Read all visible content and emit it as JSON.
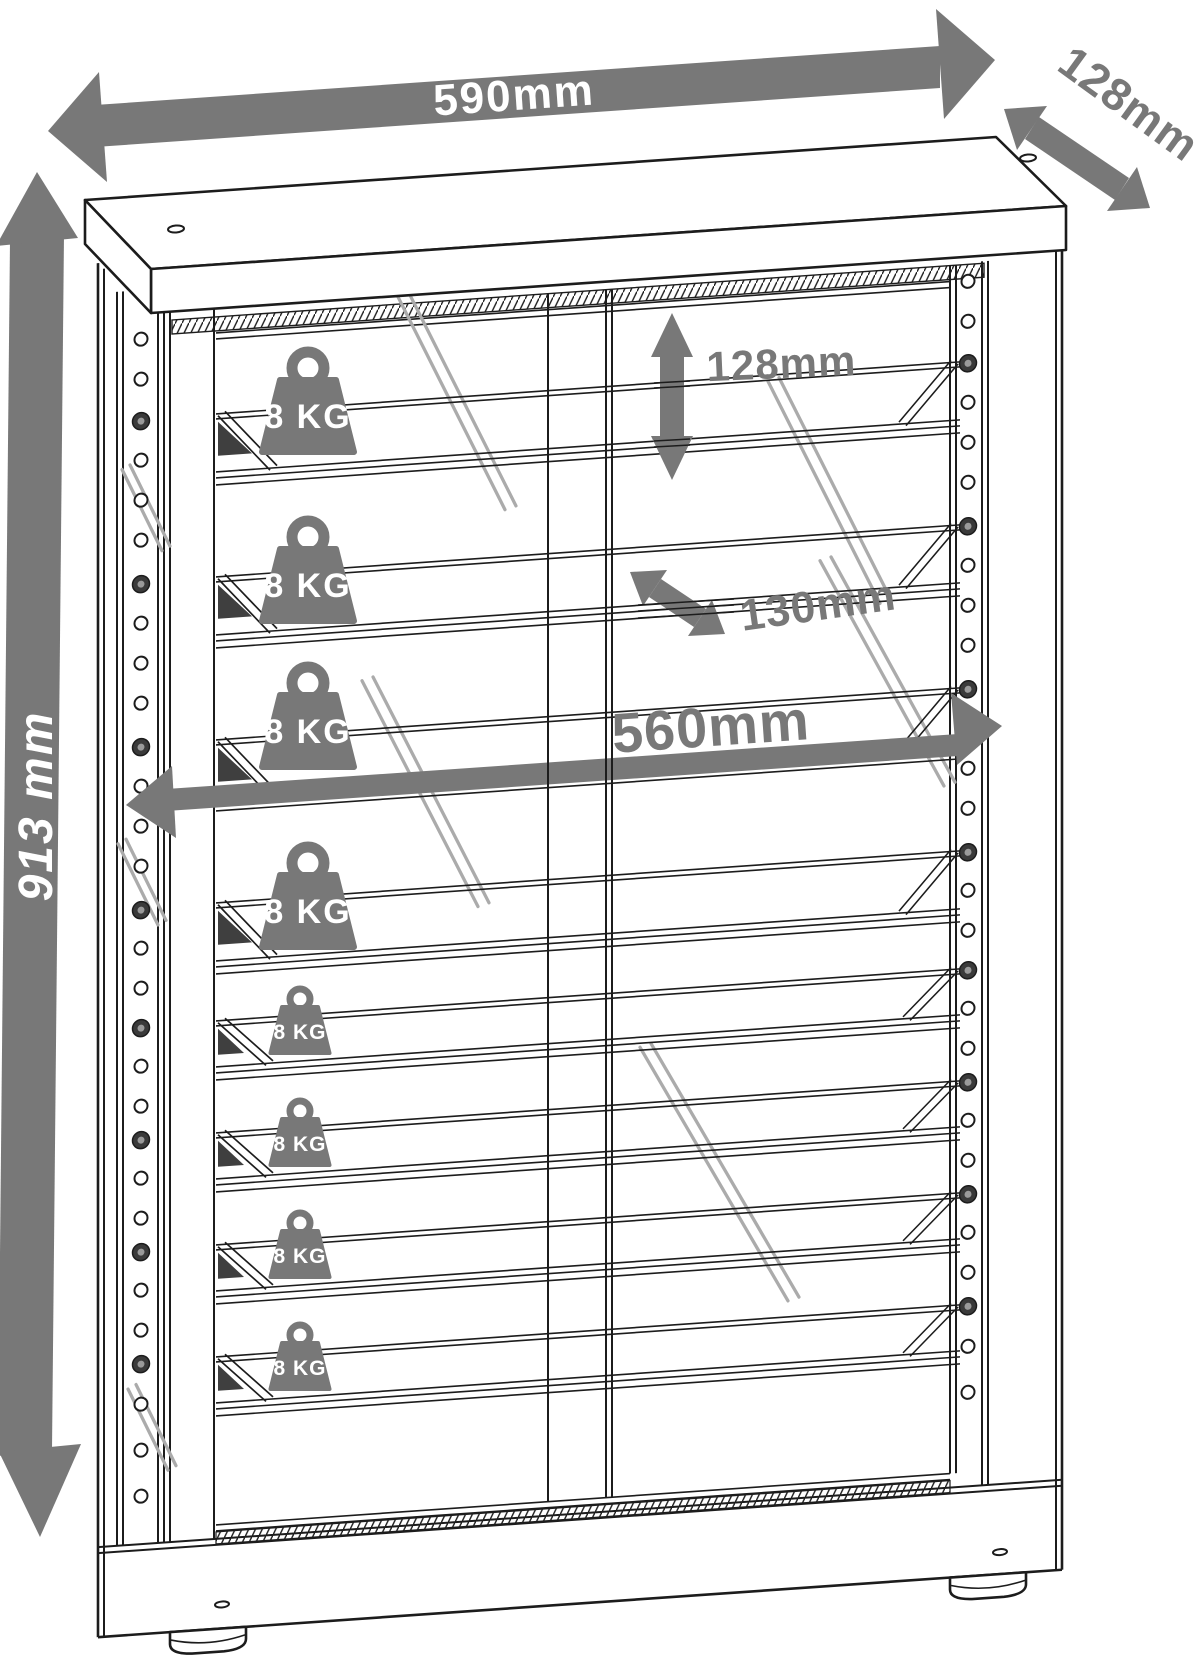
{
  "diagram": {
    "type": "furniture-dimension-drawing",
    "subject": "glass display cabinet with shelves",
    "dimensions": {
      "overall_width": "590mm",
      "overall_depth": "128mm",
      "overall_height": "913 mm",
      "compartment_height": "128mm",
      "shelf_depth": "130mm",
      "interior_width": "560mm"
    },
    "shelf_capacity_label": "8 KG",
    "colors": {
      "annotation": "#787878",
      "line": "#1c1c1c",
      "shine": "#ababab",
      "wedge": "#3f3f3f",
      "white": "#ffffff"
    }
  }
}
